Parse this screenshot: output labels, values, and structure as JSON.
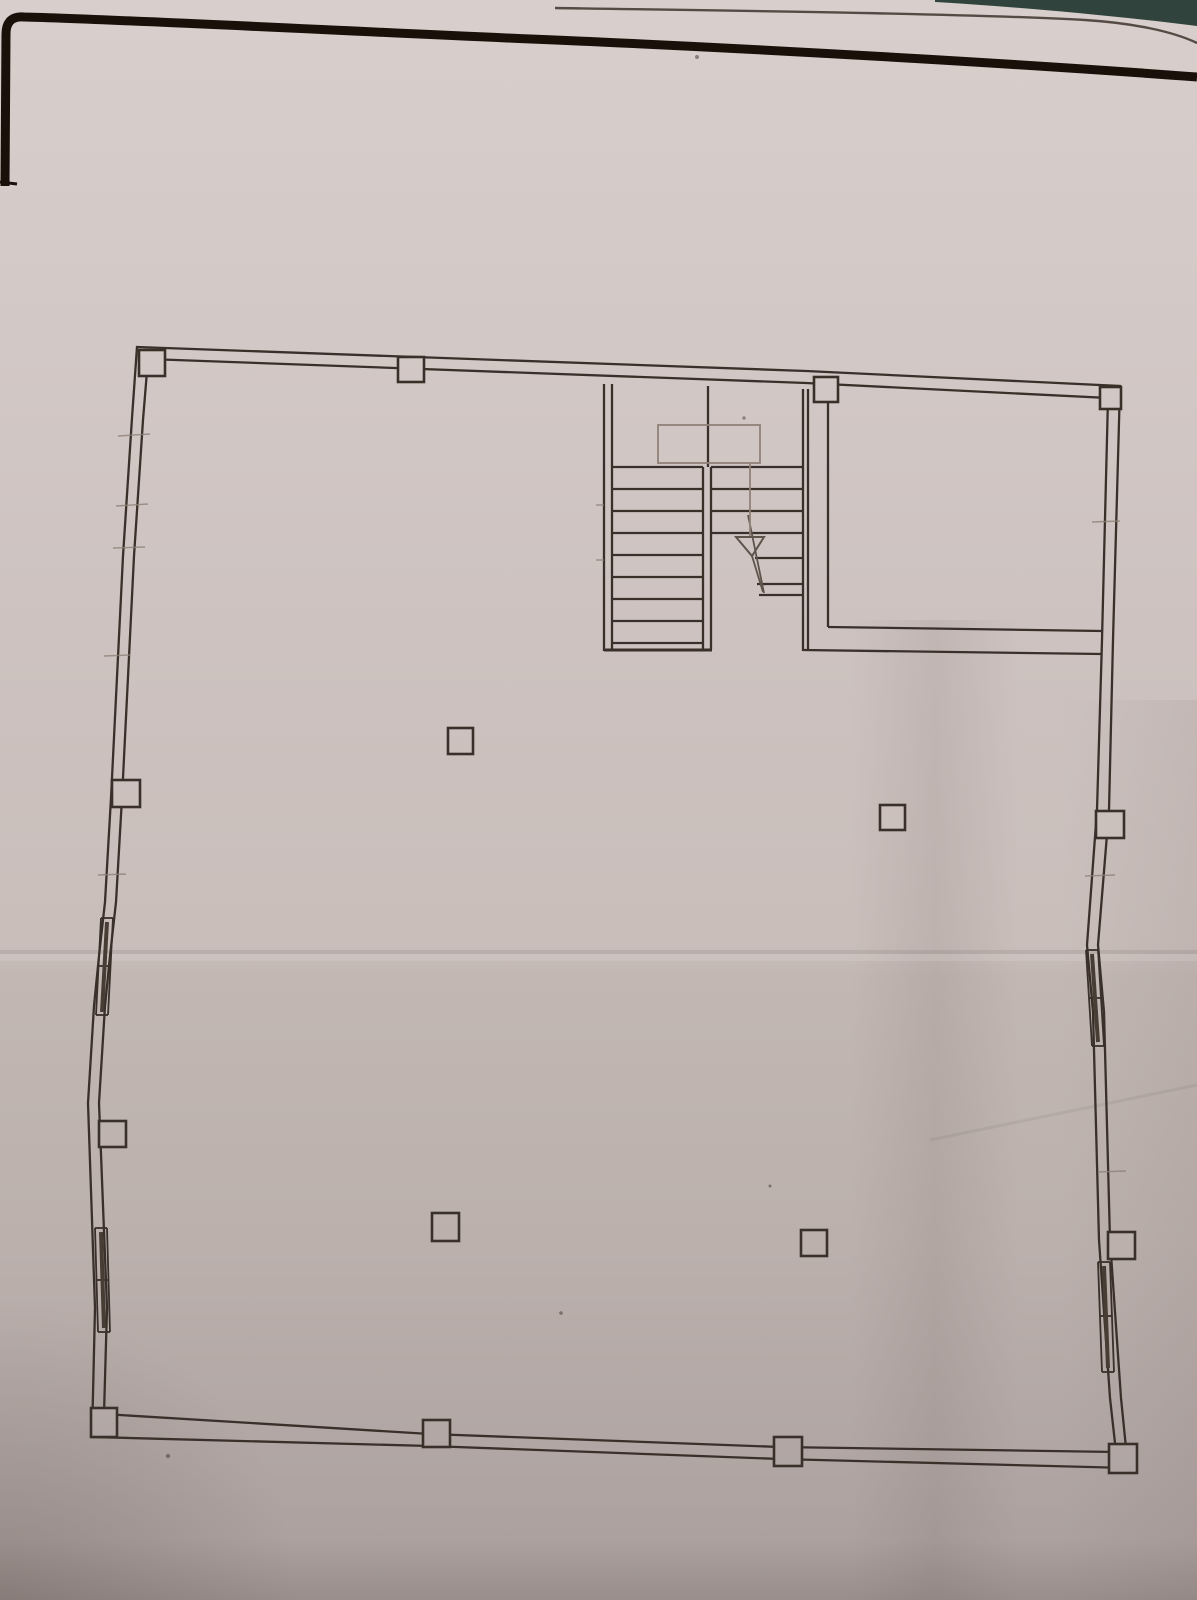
{
  "meta": {
    "description": "Photograph of a hand-drafted architectural floor plan on a creased paper sheet",
    "visible_text": ""
  },
  "palette": {
    "paper_top": "#d8cfcc",
    "paper_mid": "#c9beba",
    "paper_bottom": "#a89d9a",
    "ink": "#3a302a",
    "pencil": "#8f8178",
    "sheet_border_black": "#181009",
    "backdrop_teal": "#30443d"
  },
  "plan": {
    "areas": [
      "main-hall",
      "stairwell",
      "upper-right-room"
    ],
    "stairwell": {
      "left_flight_step_lines": 9,
      "right_flight_step_lines": 7,
      "arrow_direction": "down"
    },
    "columns": {
      "perimeter_count": 12,
      "freestanding_count": 4
    },
    "window_count": 4
  }
}
